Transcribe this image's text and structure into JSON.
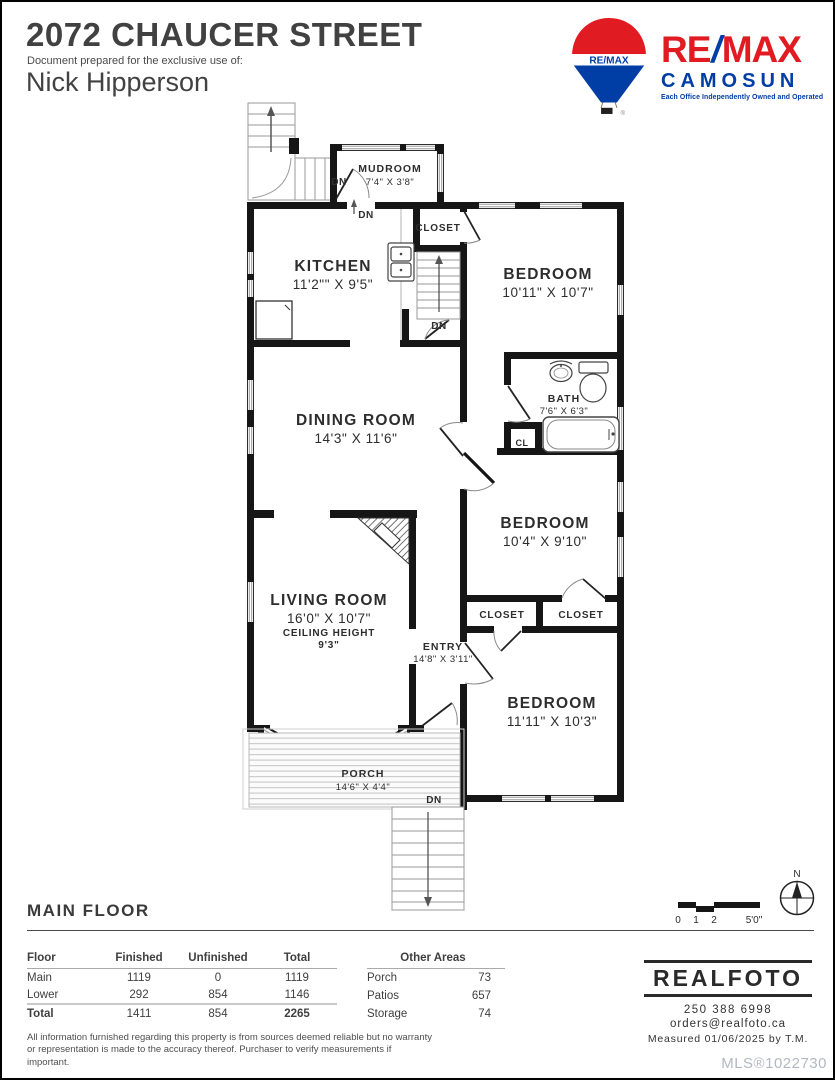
{
  "header": {
    "title": "2072 CHAUCER STREET",
    "prepared_label": "Document prepared for the exclusive use of:",
    "prepared_name": "Nick Hipperson"
  },
  "brand": {
    "balloon_text": "RE/MAX",
    "wordmark_re": "RE",
    "wordmark_slash": "/",
    "wordmark_max": "MAX",
    "office_name": "CAMOSUN",
    "tagline": "Each Office Independently Owned and Operated",
    "red": "#E11B22",
    "blue": "#003DA5"
  },
  "plan": {
    "mudroom_name": "MUDROOM",
    "mudroom_dims": "7'4\" X 3'8\"",
    "kitchen_name": "KITCHEN",
    "kitchen_dims": "11'2\"\" X 9'5\"",
    "closet_top": "CLOSET",
    "bedroom1_name": "BEDROOM",
    "bedroom1_dims": "10'11\" X 10'7\"",
    "bath_name": "BATH",
    "bath_dims": "7'6\" X 6'3\"",
    "cl": "CL",
    "dining_name": "DINING ROOM",
    "dining_dims": "14'3\" X 11'6\"",
    "bedroom2_name": "BEDROOM",
    "bedroom2_dims": "10'4\" X 9'10\"",
    "closet_left": "CLOSET",
    "closet_right": "CLOSET",
    "living_name": "LIVING ROOM",
    "living_dims": "16'0\" X 10'7\"",
    "ceiling_label": "CEILING HEIGHT",
    "ceiling_value": "9'3\"",
    "entry_name": "ENTRY",
    "entry_dims": "14'8\" X 3'11\"",
    "bedroom3_name": "BEDROOM",
    "bedroom3_dims": "11'11\" X 10'3\"",
    "porch_name": "PORCH",
    "porch_dims": "14'6\" X 4'4\"",
    "dn": "DN",
    "north": "N",
    "scale_0": "0",
    "scale_1": "1",
    "scale_2": "2",
    "scale_5": "5'0\""
  },
  "section_title": "MAIN FLOOR",
  "area_table": {
    "headers": [
      "Floor",
      "Finished",
      "Unfinished",
      "Total"
    ],
    "rows": [
      {
        "floor": "Main",
        "finished": "1119",
        "unfinished": "0",
        "total": "1119"
      },
      {
        "floor": "Lower",
        "finished": "292",
        "unfinished": "854",
        "total": "1146"
      }
    ],
    "total": {
      "floor": "Total",
      "finished": "1411",
      "unfinished": "854",
      "total": "2265"
    }
  },
  "other_areas": {
    "header": "Other Areas",
    "rows": [
      {
        "label": "Porch",
        "value": "73"
      },
      {
        "label": "Patios",
        "value": "657"
      },
      {
        "label": "Storage",
        "value": "74"
      }
    ]
  },
  "footer": {
    "disclaimer": "All information furnished regarding this property is from sources deemed reliable but no warranty or representation is made to the accuracy thereof. Purchaser to verify measurements if important.",
    "realfoto_logo": "REALFOTO",
    "phone": "250 388 6998",
    "email": "orders@realfoto.ca",
    "measured_label": "Measured",
    "measured_date": "01/06/2025",
    "measured_by": "by T.M.",
    "mls": "MLS®1022730"
  }
}
